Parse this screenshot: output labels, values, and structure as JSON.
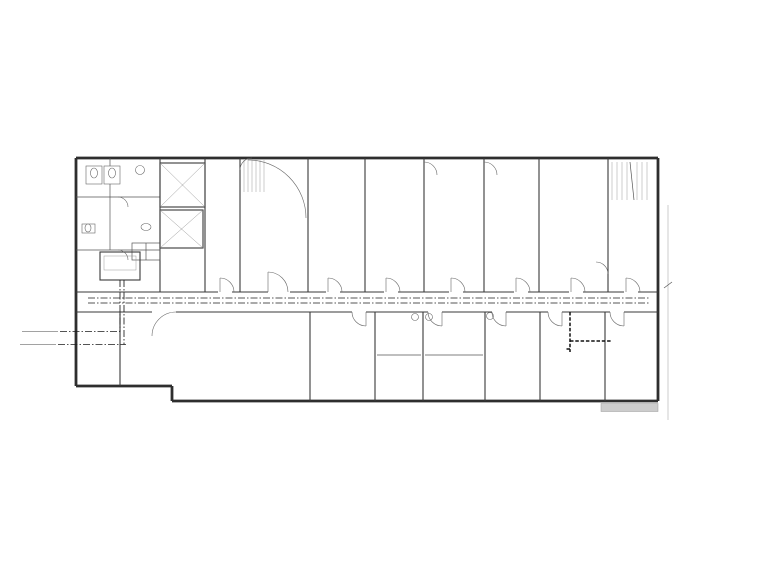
{
  "drawing": {
    "overall_width": "40000",
    "overall_height": "17400"
  },
  "grid": {
    "top": {
      "bubbles": [
        {
          "l": "1",
          "x": 85
        },
        {
          "l": "2",
          "x": 140
        },
        {
          "l": "3",
          "x": 166
        },
        {
          "l": "5",
          "x": 204
        },
        {
          "l": "6",
          "x": 258
        },
        {
          "l": "7",
          "x": 308
        },
        {
          "l": "8",
          "x": 365
        },
        {
          "l": "9",
          "x": 424
        },
        {
          "l": "10",
          "x": 484
        },
        {
          "l": "11",
          "x": 539
        },
        {
          "l": "12",
          "x": 608
        },
        {
          "l": "13",
          "x": 653
        }
      ],
      "ticks": [
        85,
        140,
        166,
        176,
        204,
        250,
        258,
        308,
        365,
        424,
        484,
        539,
        608,
        653
      ],
      "dims": [
        "3800",
        "1500",
        "400",
        "2600",
        "3500",
        "300",
        "3600",
        "2900",
        "4200",
        "4200",
        "3900",
        "4800",
        "3300"
      ]
    },
    "bottom": {
      "bubbles": [
        {
          "l": "1",
          "x": 85
        },
        {
          "l": "2",
          "x": 139
        },
        {
          "l": "4",
          "x": 180
        },
        {
          "l": "7",
          "x": 308
        },
        {
          "l": "8",
          "x": 363
        },
        {
          "l": "9",
          "x": 423
        },
        {
          "l": "10",
          "x": 483
        },
        {
          "l": "11",
          "x": 538
        },
        {
          "l": "13",
          "x": 653
        }
      ],
      "ticks": [
        85,
        139,
        180,
        193,
        253,
        308,
        363,
        376,
        423,
        483,
        538,
        606,
        653
      ],
      "dims": [
        "3800",
        "2900",
        "900",
        "4200",
        "3900",
        "3900",
        "900",
        "3300",
        "4200",
        "3900",
        "4800",
        "3300"
      ]
    },
    "left": {
      "bubbles": [
        {
          "l": "G",
          "y": 160
        },
        {
          "l": "F",
          "y": 197
        },
        {
          "l": "E",
          "y": 262
        },
        {
          "l": "C",
          "y": 304
        },
        {
          "l": "A",
          "y": 391
        }
      ],
      "ticks": [
        160,
        197,
        222,
        230,
        262,
        304,
        312,
        342,
        391,
        408
      ],
      "dims": [
        "2700",
        "1800",
        "600",
        "1900",
        "3000",
        "600",
        "2100",
        "3300",
        "1200"
      ]
    },
    "right": {
      "bubbles": [
        {
          "l": "G",
          "y": 160
        },
        {
          "l": "E",
          "y": 262
        },
        {
          "l": "D",
          "y": 305
        },
        {
          "l": "A",
          "y": 391
        }
      ],
      "ticks": [
        160,
        262,
        305,
        391,
        408
      ],
      "dims": [
        "7200",
        "3000",
        "6000",
        "1200"
      ]
    }
  },
  "windows": {
    "top": [
      {
        "t": "C0918",
        "x": 148
      },
      {
        "t": "C3020",
        "x": 228
      },
      {
        "t": "C2120",
        "x": 292
      },
      {
        "t": "C2120",
        "x": 340
      },
      {
        "t": "C2120",
        "x": 390
      },
      {
        "t": "C2120",
        "x": 438
      },
      {
        "t": "C2120",
        "x": 505
      },
      {
        "t": "C2120",
        "x": 560
      },
      {
        "t": "C2120",
        "x": 625
      }
    ],
    "bottom_upper": [
      {
        "t": "MC2124",
        "x": 98
      },
      {
        "t": "MC2124",
        "x": 143
      }
    ],
    "bottom_lower": [
      {
        "t": "MC2124",
        "x": 220
      },
      {
        "t": "MC2124",
        "x": 270
      },
      {
        "t": "MC2124",
        "x": 325
      },
      {
        "t": "MC2124",
        "x": 385
      },
      {
        "t": "MC2124",
        "x": 445
      },
      {
        "t": "MC2124",
        "x": 505
      },
      {
        "t": "MC2124",
        "x": 556
      },
      {
        "t": "MC2124",
        "x": 606
      }
    ],
    "left": [
      {
        "t": "C0918",
        "y": 205
      },
      {
        "t": "C2827",
        "y": 358
      }
    ],
    "interior": [
      {
        "t": "C2525",
        "x": 399,
        "y": 348
      },
      {
        "t": "C2525",
        "x": 449,
        "y": 348
      }
    ]
  },
  "rooms": [
    {
      "t": "LT1",
      "x": 278,
      "y": 177
    },
    {
      "t": "LT2",
      "x": 624,
      "y": 174
    },
    {
      "t": "VIP1",
      "x": 389,
      "y": 191
    },
    {
      "t": "VIP2",
      "x": 503,
      "y": 191
    },
    {
      "t": "内科",
      "x": 340,
      "y": 199
    },
    {
      "t": "挂号",
      "x": 222,
      "y": 209
    },
    {
      "t": "女卫",
      "x": 97,
      "y": 188,
      "s": 3.8
    },
    {
      "t": "浴室",
      "x": 123,
      "y": 178,
      "s": 3.8
    },
    {
      "t": "男卫",
      "x": 93,
      "y": 219,
      "s": 3.8
    },
    {
      "t": "盥洗间",
      "x": 95,
      "y": 242,
      "s": 3.6
    },
    {
      "t": "开水间",
      "x": 128,
      "y": 240,
      "s": 3.6
    },
    {
      "t": "(电水器)",
      "x": 128,
      "y": 246,
      "s": 3.3
    },
    {
      "t": "排风机房(W)",
      "x": 176,
      "y": 259,
      "s": 3.3
    },
    {
      "t": "风",
      "x": 138,
      "y": 255,
      "s": 3.4
    },
    {
      "t": "强电",
      "x": 152,
      "y": 254,
      "s": 3.4
    },
    {
      "t": "无障碍电梯兼",
      "x": 182,
      "y": 180,
      "s": 3.6
    },
    {
      "t": "消防电梯",
      "x": 182,
      "y": 186,
      "s": 3.6
    },
    {
      "t": "电梯",
      "x": 180,
      "y": 231,
      "s": 4
    },
    {
      "t": "值班室",
      "x": 97,
      "y": 370,
      "s": 4
    },
    {
      "t": "普通门诊候诊区",
      "x": 176,
      "y": 346,
      "s": 4.2
    },
    {
      "t": "护士站",
      "x": 328,
      "y": 347,
      "s": 4
    },
    {
      "t": "检验抽血",
      "x": 399,
      "y": 343,
      "s": 4
    },
    {
      "t": "治疗",
      "x": 452,
      "y": 343,
      "s": 4
    },
    {
      "t": "诊3",
      "x": 397,
      "y": 369,
      "s": 4
    },
    {
      "t": "诊4",
      "x": 455,
      "y": 371,
      "s": 4
    },
    {
      "t": "医生办公室",
      "x": 572,
      "y": 364,
      "s": 4
    },
    {
      "t": "主任办公室",
      "x": 626,
      "y": 364,
      "s": 4
    }
  ],
  "doors": [
    {
      "t": "M1021",
      "x": 357,
      "y": 188,
      "r": -90
    },
    {
      "t": "M1021",
      "x": 424,
      "y": 180,
      "r": -90
    },
    {
      "t": "M1021",
      "x": 486,
      "y": 180,
      "r": -90
    },
    {
      "t": "M1121",
      "x": 592,
      "y": 267,
      "r": -90
    },
    {
      "t": "M1021",
      "x": 545,
      "y": 323,
      "r": -90
    },
    {
      "t": "M0821",
      "x": 131,
      "y": 258,
      "r": -90
    },
    {
      "t": "M0821",
      "x": 125,
      "y": 340,
      "r": -90
    },
    {
      "t": "FM乙1521-1",
      "x": 246,
      "y": 192,
      "r": -90,
      "s": 3.1
    },
    {
      "t": "FM乙1521-1",
      "x": 604,
      "y": 280,
      "r": -90,
      "s": 3.1
    }
  ],
  "levels": [
    {
      "t": "11.400",
      "x": 332,
      "y": 165
    },
    {
      "t": "11.400",
      "x": 632,
      "y": 273
    }
  ],
  "pipes": {
    "mains": [
      {
        "t": "MH-1  DN150",
        "x": 22,
        "y": 329
      },
      {
        "t": "MG-1  DN150",
        "x": 20,
        "y": 342
      }
    ],
    "line_labels": [
      {
        "t": "LH",
        "x": 178,
        "y": 294
      },
      {
        "t": "LH",
        "x": 468,
        "y": 294
      },
      {
        "t": "LH",
        "x": 636,
        "y": 294
      },
      {
        "t": "MG",
        "x": 242,
        "y": 310
      },
      {
        "t": "MH",
        "x": 300,
        "y": 301
      },
      {
        "t": "MG",
        "x": 520,
        "y": 310
      },
      {
        "t": "MH",
        "x": 560,
        "y": 301
      }
    ],
    "riser_stack": [
      "DN40",
      "DN32",
      "DN25",
      "DN20"
    ],
    "riser_positions": [
      [
        205,
        261
      ],
      [
        258,
        261
      ],
      [
        310,
        261
      ],
      [
        375,
        261
      ],
      [
        440,
        261
      ],
      [
        500,
        261
      ],
      [
        550,
        261
      ],
      [
        610,
        254
      ]
    ],
    "left_stack": [
      "DN32",
      "DN25",
      "DN20"
    ],
    "left_stack_pos": [
      134,
      305
    ],
    "rot_labels": [
      {
        "t": "DN40",
        "x": 148,
        "y": 244,
        "r": -90
      },
      {
        "t": "DN40",
        "x": 224,
        "y": 287,
        "r": -90
      }
    ]
  },
  "equipment": {
    "ahu_label": "HDX-47",
    "fcu_label": "FP-63",
    "fcu_top": [
      [
        216,
        226
      ],
      [
        322,
        231
      ],
      [
        380,
        230
      ],
      [
        444,
        231
      ],
      [
        496,
        231
      ],
      [
        560,
        231
      ]
    ],
    "fcu_bottom": [
      [
        102,
        356
      ],
      [
        145,
        318
      ],
      [
        212,
        318
      ],
      [
        268,
        318
      ],
      [
        325,
        330
      ],
      [
        382,
        328
      ],
      [
        450,
        330
      ],
      [
        515,
        330
      ],
      [
        573,
        352
      ],
      [
        620,
        341
      ]
    ]
  },
  "furniture": {
    "chair": {
      "w": 12,
      "h": 7.5
    },
    "groups": [
      {
        "x0": 128,
        "y0": 318,
        "cols": 4,
        "rows": 5,
        "dx": 17.5,
        "dy": 13
      },
      {
        "x0": 203,
        "y0": 318,
        "cols": 4,
        "rows": 5,
        "dx": 17.5,
        "dy": 13
      }
    ],
    "desks": [
      [
        318,
        206,
        40,
        4
      ],
      [
        370,
        206,
        40,
        4
      ],
      [
        495,
        206,
        38,
        4
      ],
      [
        549,
        206,
        38,
        4
      ]
    ]
  },
  "note": {
    "l1": "已有建筑，按主楼大开间，",
    "l2": "留大空间隔断灵活。",
    "x": 641,
    "y": 246
  },
  "colors": {
    "line": "#3a3a3a",
    "grid": "#c9c9c9",
    "dim": "#8a8a8a",
    "fill_gray": "#cccccc"
  }
}
